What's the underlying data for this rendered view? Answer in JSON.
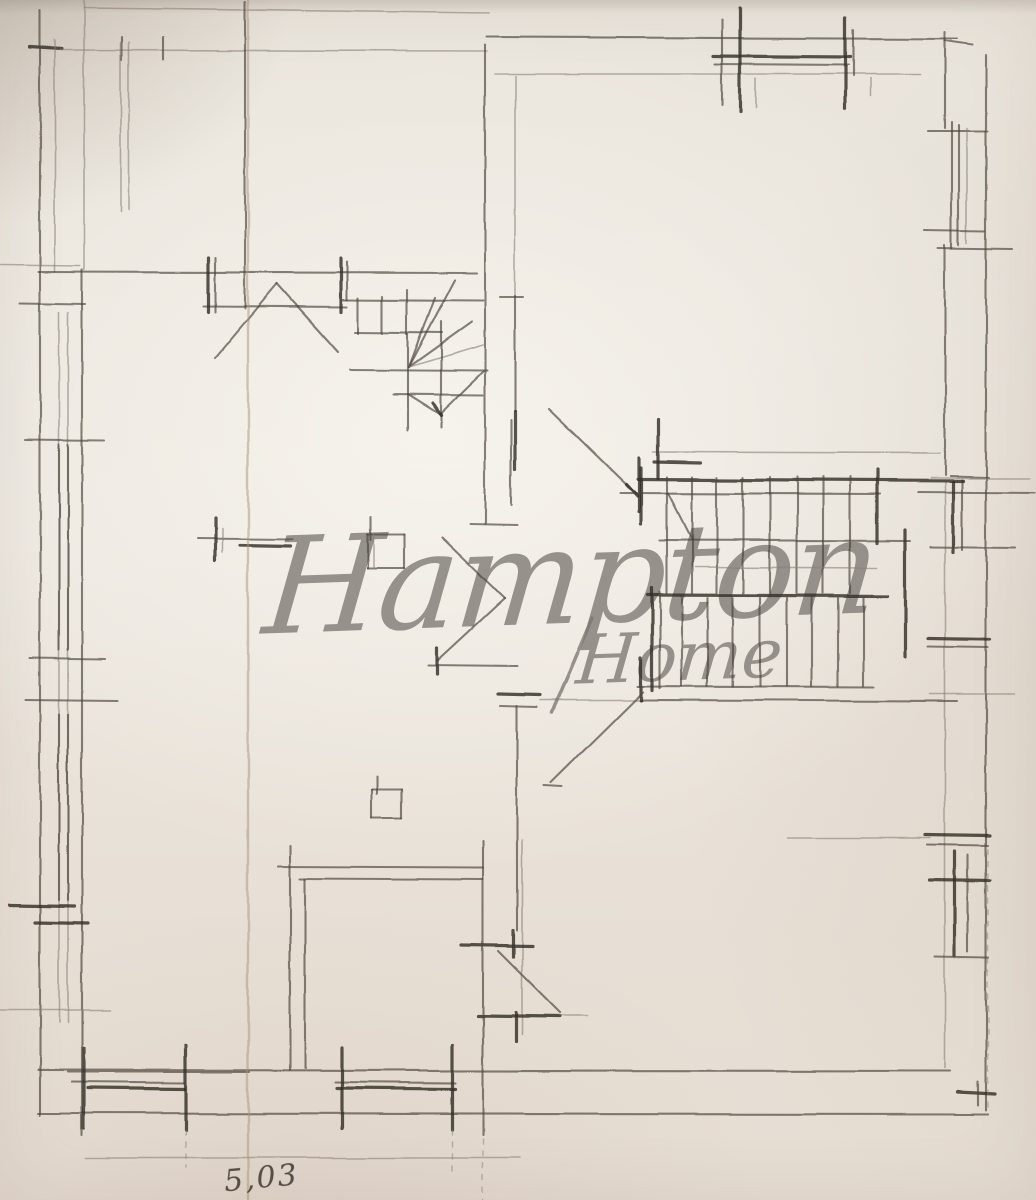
{
  "document": {
    "kind": "hand-drawn pencil floor plan sketch on paper"
  },
  "watermark": {
    "line1": "Hampton",
    "line2": "Home"
  },
  "annotation": {
    "dimension_label": "5,03"
  },
  "palette": {
    "paper": "#e9e4db",
    "pencil_dark": "#332e29",
    "pencil_mid": "#4a443c",
    "pencil_light": "#8a8177",
    "crease": "#a8937c",
    "watermark": "#7d7872",
    "annotation_ink": "#3e372f"
  },
  "drawing": {
    "width": 1036,
    "height": 1200,
    "stroke_classes": {
      "h": "heavy-pencil-stroke",
      "m": "medium-pencil-stroke",
      "l": "light-pencil-stroke",
      "d": "dashed-guide-line",
      "c": "paper-fold-crease",
      "w": "watermark-swash"
    },
    "segments": [
      [
        84,
        8,
        490,
        13,
        "l"
      ],
      [
        30,
        47,
        62,
        49,
        "h"
      ],
      [
        60,
        50,
        487,
        51,
        "l"
      ],
      [
        122,
        37,
        122,
        60,
        "m"
      ],
      [
        163,
        37,
        163,
        60,
        "m"
      ],
      [
        121,
        42,
        121,
        212,
        "l"
      ],
      [
        129,
        42,
        129,
        210,
        "l"
      ],
      [
        487,
        37,
        958,
        39,
        "m"
      ],
      [
        495,
        74,
        920,
        74,
        "l"
      ],
      [
        713,
        56,
        850,
        57,
        "h"
      ],
      [
        715,
        64,
        848,
        65,
        "m"
      ],
      [
        722,
        20,
        722,
        105,
        "m"
      ],
      [
        740,
        8,
        740,
        112,
        "h"
      ],
      [
        845,
        18,
        845,
        108,
        "h"
      ],
      [
        853,
        30,
        853,
        76,
        "m"
      ],
      [
        756,
        78,
        756,
        108,
        "l"
      ],
      [
        870,
        78,
        870,
        96,
        "l"
      ],
      [
        945,
        32,
        945,
        128,
        "m"
      ],
      [
        945,
        41,
        973,
        45,
        "m"
      ],
      [
        928,
        131,
        988,
        131,
        "m"
      ],
      [
        986,
        55,
        986,
        1110,
        "m"
      ],
      [
        945,
        245,
        945,
        475,
        "m"
      ],
      [
        950,
        476,
        988,
        477,
        "m"
      ],
      [
        945,
        482,
        945,
        1068,
        "l"
      ],
      [
        952,
        122,
        952,
        248,
        "m"
      ],
      [
        959,
        125,
        959,
        245,
        "m"
      ],
      [
        967,
        128,
        967,
        243,
        "l"
      ],
      [
        925,
        230,
        985,
        231,
        "m"
      ],
      [
        938,
        248,
        1012,
        249,
        "m"
      ],
      [
        930,
        478,
        1030,
        478,
        "l"
      ],
      [
        918,
        492,
        1035,
        493,
        "m"
      ],
      [
        953,
        482,
        953,
        552,
        "h"
      ],
      [
        962,
        480,
        962,
        550,
        "m"
      ],
      [
        930,
        547,
        1015,
        548,
        "m"
      ],
      [
        928,
        638,
        990,
        639,
        "h"
      ],
      [
        928,
        646,
        988,
        647,
        "m"
      ],
      [
        930,
        694,
        1015,
        694,
        "l"
      ],
      [
        788,
        838,
        930,
        838,
        "l"
      ],
      [
        925,
        835,
        990,
        836,
        "h"
      ],
      [
        927,
        845,
        988,
        846,
        "m"
      ],
      [
        930,
        880,
        990,
        881,
        "h"
      ],
      [
        955,
        852,
        955,
        956,
        "h"
      ],
      [
        968,
        855,
        968,
        952,
        "m"
      ],
      [
        935,
        957,
        988,
        958,
        "m"
      ],
      [
        958,
        1092,
        995,
        1094,
        "h"
      ],
      [
        978,
        1082,
        978,
        1105,
        "m"
      ],
      [
        988,
        850,
        988,
        1108,
        "d"
      ],
      [
        40,
        10,
        40,
        1115,
        "m"
      ],
      [
        55,
        40,
        55,
        272,
        "l"
      ],
      [
        84,
        0,
        84,
        270,
        "l"
      ],
      [
        82,
        270,
        82,
        1135,
        "m"
      ],
      [
        59,
        312,
        59,
        1022,
        "l"
      ],
      [
        68,
        312,
        68,
        1022,
        "l"
      ],
      [
        59,
        445,
        59,
        650,
        "m"
      ],
      [
        68,
        445,
        68,
        650,
        "m"
      ],
      [
        59,
        715,
        59,
        900,
        "m"
      ],
      [
        68,
        715,
        68,
        900,
        "m"
      ],
      [
        25,
        440,
        105,
        441,
        "m"
      ],
      [
        30,
        658,
        105,
        659,
        "m"
      ],
      [
        25,
        700,
        118,
        701,
        "m"
      ],
      [
        10,
        905,
        75,
        906,
        "h"
      ],
      [
        35,
        922,
        88,
        923,
        "h"
      ],
      [
        0,
        1010,
        110,
        1010,
        "l"
      ],
      [
        0,
        265,
        80,
        266,
        "l"
      ],
      [
        20,
        303,
        85,
        304,
        "m"
      ],
      [
        245,
        2,
        245,
        308,
        "m"
      ],
      [
        38,
        272,
        477,
        273,
        "m"
      ],
      [
        203,
        306,
        347,
        307,
        "m"
      ],
      [
        208,
        258,
        208,
        312,
        "h"
      ],
      [
        215,
        258,
        215,
        312,
        "m"
      ],
      [
        341,
        258,
        341,
        312,
        "h"
      ],
      [
        347,
        262,
        347,
        300,
        "m"
      ],
      [
        215,
        358,
        277,
        284,
        "m"
      ],
      [
        277,
        284,
        338,
        352,
        "m"
      ],
      [
        342,
        300,
        483,
        301,
        "m"
      ],
      [
        358,
        298,
        358,
        333,
        "m"
      ],
      [
        382,
        296,
        382,
        333,
        "m"
      ],
      [
        407,
        290,
        407,
        334,
        "m"
      ],
      [
        355,
        332,
        442,
        333,
        "m"
      ],
      [
        409,
        367,
        435,
        298,
        "m"
      ],
      [
        409,
        367,
        455,
        280,
        "m"
      ],
      [
        409,
        367,
        472,
        322,
        "m"
      ],
      [
        409,
        367,
        483,
        345,
        "l"
      ],
      [
        441,
        322,
        441,
        427,
        "m"
      ],
      [
        408,
        334,
        408,
        430,
        "m"
      ],
      [
        350,
        370,
        487,
        371,
        "m"
      ],
      [
        393,
        394,
        483,
        395,
        "m"
      ],
      [
        408,
        394,
        440,
        414,
        "m"
      ],
      [
        440,
        414,
        483,
        372,
        "m"
      ],
      [
        433,
        403,
        441,
        415,
        "h"
      ],
      [
        485,
        45,
        485,
        524,
        "m"
      ],
      [
        470,
        524,
        517,
        525,
        "m"
      ],
      [
        515,
        76,
        515,
        296,
        "l"
      ],
      [
        500,
        297,
        523,
        297,
        "m"
      ],
      [
        515,
        296,
        515,
        412,
        "m"
      ],
      [
        515,
        412,
        515,
        470,
        "h"
      ],
      [
        511,
        420,
        511,
        505,
        "m"
      ],
      [
        549,
        409,
        636,
        494,
        "m"
      ],
      [
        626,
        484,
        637,
        496,
        "h"
      ],
      [
        641,
        468,
        641,
        524,
        "h"
      ],
      [
        442,
        537,
        505,
        598,
        "m"
      ],
      [
        505,
        598,
        438,
        660,
        "m"
      ],
      [
        428,
        665,
        517,
        666,
        "m"
      ],
      [
        437,
        648,
        437,
        674,
        "h"
      ],
      [
        498,
        694,
        540,
        695,
        "h"
      ],
      [
        500,
        706,
        537,
        707,
        "m"
      ],
      [
        540,
        700,
        640,
        700,
        "l"
      ],
      [
        640,
        700,
        957,
        701,
        "m"
      ],
      [
        641,
        658,
        641,
        700,
        "h"
      ],
      [
        551,
        783,
        643,
        692,
        "m"
      ],
      [
        544,
        786,
        562,
        787,
        "m"
      ],
      [
        517,
        706,
        517,
        930,
        "m"
      ],
      [
        513,
        930,
        513,
        957,
        "h"
      ],
      [
        516,
        1013,
        516,
        1042,
        "h"
      ],
      [
        522,
        840,
        522,
        1035,
        "l"
      ],
      [
        462,
        945,
        532,
        946,
        "h"
      ],
      [
        478,
        1016,
        560,
        1017,
        "h"
      ],
      [
        560,
        1016,
        588,
        1016,
        "l"
      ],
      [
        498,
        951,
        560,
        1013,
        "m"
      ],
      [
        278,
        867,
        483,
        868,
        "m"
      ],
      [
        300,
        879,
        483,
        880,
        "m"
      ],
      [
        290,
        845,
        290,
        1070,
        "m"
      ],
      [
        305,
        879,
        305,
        1068,
        "m"
      ],
      [
        483,
        840,
        483,
        1135,
        "m"
      ],
      [
        38,
        1070,
        950,
        1071,
        "m"
      ],
      [
        38,
        1113,
        988,
        1114,
        "m"
      ],
      [
        85,
        1158,
        520,
        1158,
        "l"
      ],
      [
        68,
        1072,
        250,
        1072,
        "m"
      ],
      [
        72,
        1082,
        185,
        1083,
        "m"
      ],
      [
        88,
        1088,
        185,
        1089,
        "h"
      ],
      [
        84,
        1048,
        84,
        1128,
        "h"
      ],
      [
        186,
        1045,
        186,
        1130,
        "h"
      ],
      [
        186,
        1130,
        186,
        1168,
        "d"
      ],
      [
        335,
        1082,
        455,
        1083,
        "m"
      ],
      [
        337,
        1088,
        455,
        1089,
        "h"
      ],
      [
        342,
        1048,
        342,
        1128,
        "h"
      ],
      [
        452,
        1045,
        452,
        1130,
        "h"
      ],
      [
        452,
        1130,
        452,
        1172,
        "d"
      ],
      [
        483,
        1115,
        483,
        1200,
        "d"
      ],
      [
        368,
        534,
        404,
        534,
        "m"
      ],
      [
        404,
        534,
        404,
        568,
        "m"
      ],
      [
        368,
        568,
        404,
        568,
        "m"
      ],
      [
        368,
        534,
        368,
        568,
        "m"
      ],
      [
        374,
        534,
        374,
        568,
        "l"
      ],
      [
        371,
        516,
        371,
        540,
        "m"
      ],
      [
        372,
        790,
        402,
        790,
        "m"
      ],
      [
        402,
        790,
        402,
        818,
        "m"
      ],
      [
        372,
        818,
        402,
        818,
        "m"
      ],
      [
        372,
        790,
        372,
        818,
        "m"
      ],
      [
        377,
        776,
        377,
        794,
        "m"
      ],
      [
        197,
        538,
        292,
        539,
        "m"
      ],
      [
        240,
        545,
        290,
        546,
        "h"
      ],
      [
        215,
        518,
        215,
        560,
        "h"
      ],
      [
        222,
        528,
        222,
        552,
        "l"
      ],
      [
        638,
        479,
        963,
        481,
        "h"
      ],
      [
        653,
        452,
        940,
        453,
        "l"
      ],
      [
        639,
        458,
        639,
        512,
        "h"
      ],
      [
        620,
        493,
        880,
        494,
        "m"
      ],
      [
        667,
        477,
        667,
        593,
        "m"
      ],
      [
        692,
        477,
        692,
        593,
        "m"
      ],
      [
        717,
        477,
        717,
        593,
        "m"
      ],
      [
        743,
        477,
        743,
        593,
        "m"
      ],
      [
        770,
        477,
        770,
        593,
        "m"
      ],
      [
        797,
        477,
        797,
        593,
        "m"
      ],
      [
        823,
        477,
        823,
        593,
        "m"
      ],
      [
        850,
        477,
        850,
        593,
        "m"
      ],
      [
        660,
        540,
        910,
        541,
        "m"
      ],
      [
        695,
        567,
        877,
        568,
        "l"
      ],
      [
        648,
        595,
        887,
        596,
        "h"
      ],
      [
        682,
        598,
        682,
        686,
        "m"
      ],
      [
        708,
        598,
        708,
        686,
        "m"
      ],
      [
        733,
        598,
        733,
        686,
        "m"
      ],
      [
        760,
        598,
        760,
        686,
        "m"
      ],
      [
        787,
        598,
        787,
        686,
        "m"
      ],
      [
        812,
        598,
        812,
        686,
        "m"
      ],
      [
        838,
        598,
        838,
        686,
        "m"
      ],
      [
        863,
        598,
        863,
        686,
        "m"
      ],
      [
        638,
        686,
        873,
        687,
        "m"
      ],
      [
        877,
        470,
        877,
        543,
        "h"
      ],
      [
        905,
        530,
        905,
        657,
        "h"
      ],
      [
        652,
        588,
        652,
        690,
        "h"
      ],
      [
        660,
        592,
        660,
        688,
        "m"
      ],
      [
        658,
        420,
        658,
        478,
        "h"
      ],
      [
        654,
        462,
        700,
        463,
        "h"
      ],
      [
        668,
        493,
        692,
        540,
        "m"
      ],
      [
        552,
        712,
        592,
        618,
        "w"
      ],
      [
        248,
        0,
        248,
        1200,
        "c"
      ]
    ]
  }
}
